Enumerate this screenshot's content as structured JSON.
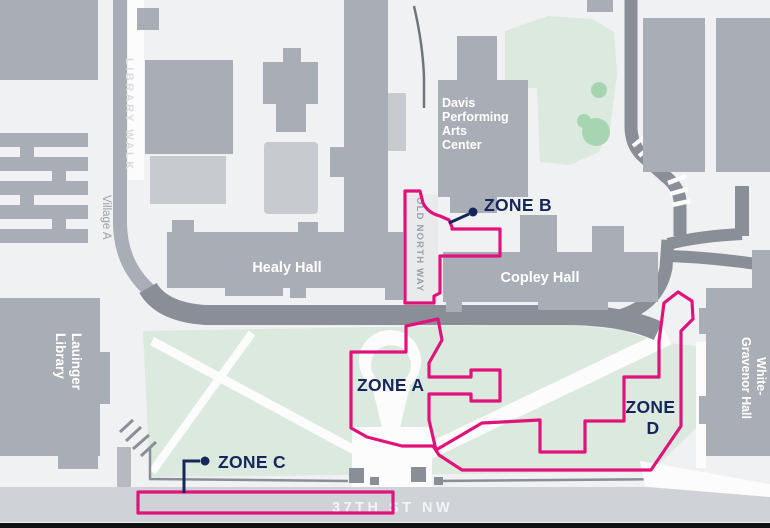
{
  "colors": {
    "background": "#F0F1F2",
    "building": "#A9AEB6",
    "building_light": "#C7CACF",
    "road": "#8A8F97",
    "walkway": "#A9AEB6",
    "street": "#CFD2D7",
    "lawn": "#DCE9DE",
    "tree": "#A7D5B1",
    "white_path": "#FCFCFD",
    "zone_outline": "#E0137B",
    "zone_label": "#15265B",
    "building_label": "#FFFFFF",
    "walk_label": "#D9DBDF",
    "path_label": "#9AA0A8",
    "street_label": "#F3F4F6",
    "frame_bar": "#101010"
  },
  "zones": {
    "a": {
      "label": "ZONE A"
    },
    "b": {
      "label": "ZONE B"
    },
    "c": {
      "label": "ZONE C"
    },
    "d": {
      "lines": [
        "ZONE",
        "D"
      ]
    }
  },
  "buildings": {
    "healy": {
      "label": "Healy Hall"
    },
    "copley": {
      "label": "Copley Hall"
    },
    "davis": {
      "lines": [
        "Davis",
        "Performing",
        "Arts",
        "Center"
      ]
    },
    "lauinger": {
      "lines": [
        "Lauinger",
        "Library"
      ]
    },
    "white_gravenor": {
      "lines": [
        "White-",
        "Gravenor Hall"
      ]
    },
    "village_a": {
      "label": "Village A"
    }
  },
  "walkways": {
    "library_walk": {
      "label": "LIBRARY WALK"
    },
    "old_north_way": {
      "label": "OLD NORTH WAY"
    },
    "street_37th": {
      "label": "37TH ST NW"
    }
  }
}
